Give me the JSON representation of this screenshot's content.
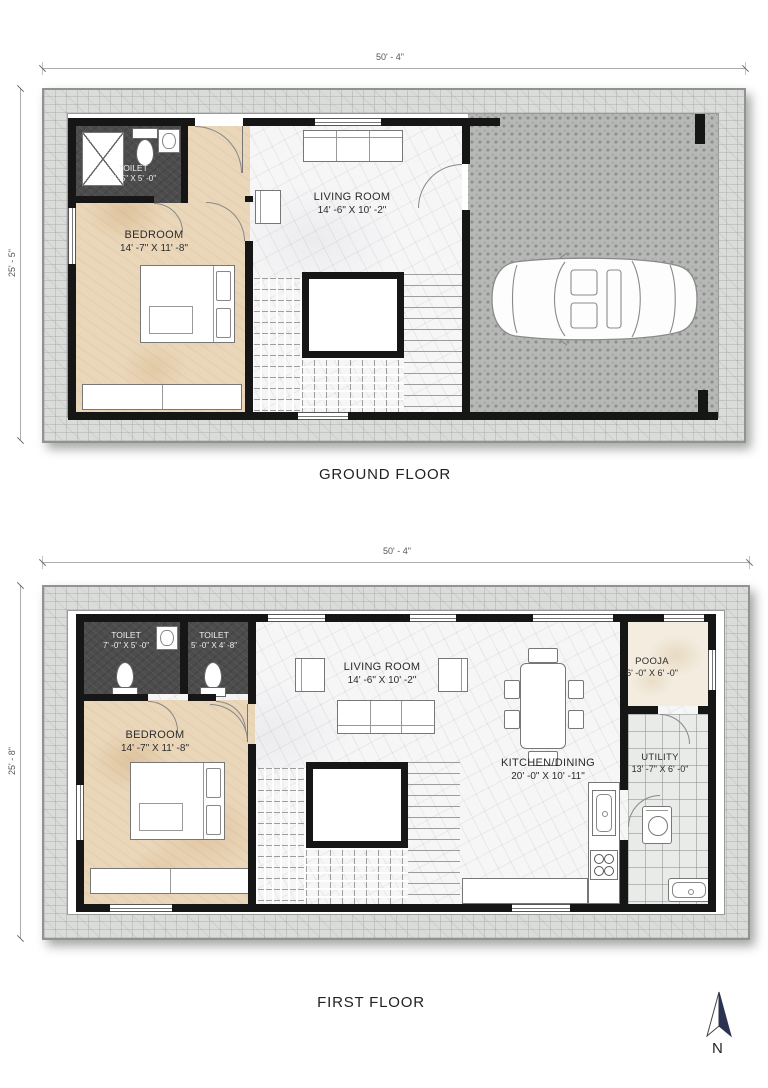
{
  "ground_floor": {
    "title": "GROUND FLOOR",
    "width_dim": "50' - 4\"",
    "height_dim": "25' - 5\"",
    "toilet": {
      "name": "TOILET",
      "size": "7' -5\" X 5' -0\""
    },
    "bedroom": {
      "name": "BEDROOM",
      "size": "14' -7\" X 11' -8\""
    },
    "living": {
      "name": "LIVING ROOM",
      "size": "14' -6\" X 10' -2\""
    }
  },
  "first_floor": {
    "title": "FIRST FLOOR",
    "width_dim": "50' - 4\"",
    "height_dim": "25' - 8\"",
    "toilet1": {
      "name": "TOILET",
      "size": "7' -0\" X 5' -0\""
    },
    "toilet2": {
      "name": "TOILET",
      "size": "5' -0\" X 4' -8\""
    },
    "bedroom": {
      "name": "BEDROOM",
      "size": "14' -7\" X 11' -8\""
    },
    "living": {
      "name": "LIVING ROOM",
      "size": "14' -6\" X 10' -2\""
    },
    "kitchen": {
      "name": "KITCHEN/DINING",
      "size": "20' -0\" X 10' -11\""
    },
    "pooja": {
      "name": "POOJA",
      "size": "6' -0\" X 6' -0\""
    },
    "utility": {
      "name": "UTILITY",
      "size": "13' -7\" X 6' -0\""
    }
  },
  "compass": {
    "label": "N"
  },
  "colors": {
    "wall": "#161616",
    "stone_band": "#dadcda",
    "paver": "#b6b8b6",
    "marble_tan": "#ead7ba",
    "marble_white": "#f6f6f7",
    "toilet_floor": "#4c4c4c",
    "north_arrow": "#2b3350"
  }
}
